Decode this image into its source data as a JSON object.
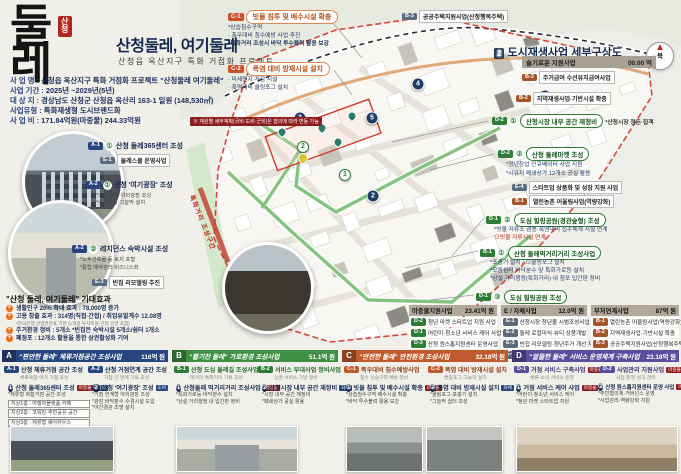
{
  "logo": {
    "main": "둘레",
    "seal": "산청"
  },
  "header": {
    "title": "산청둘레, 여기둘레",
    "subtitle": "산청읍 옥산지구 특화 거점화 프로젝트"
  },
  "info": [
    {
      "label": "사 업 명 :",
      "value": "산청읍 옥산지구 특화 거점화 프로젝트 \"산청둘레 여기둘레\""
    },
    {
      "label": "사업 기간 :",
      "value": "2025년 ~2029년(5년)"
    },
    {
      "label": "대 상 지 :",
      "value": "경상남도 산청군 산청읍 옥산리 163-1 일원 (148,530㎡)"
    },
    {
      "label": "사업유형 :",
      "value": "특화재생형 도시브랜드화"
    },
    {
      "label": "사 업 비 :",
      "value": "171.84억원(마중물) 244.33억원"
    }
  ],
  "info_note": "※ 재원별 세부계획(국비·도비·군비)은 협의에 따라 변동 가능",
  "map": {
    "title_num": "2",
    "title": "도시재생사업 세부구상도",
    "compass": "북",
    "top_tag": "B-3",
    "top_label": "공공주택지원사업(산청행복주택)",
    "road_label": "특화거리 조성구간",
    "markers": [
      {
        "type": "navy",
        "n": "1",
        "x": 292,
        "y": 262
      },
      {
        "type": "navy",
        "n": "2",
        "x": 373,
        "y": 196
      },
      {
        "type": "navy",
        "n": "3",
        "x": 300,
        "y": 118
      },
      {
        "type": "navy",
        "n": "4",
        "x": 418,
        "y": 84
      },
      {
        "type": "navy",
        "n": "5",
        "x": 372,
        "y": 118
      },
      {
        "type": "navy",
        "n": "6",
        "x": 545,
        "y": 96
      },
      {
        "type": "green",
        "n": "2",
        "x": 303,
        "y": 147
      },
      {
        "type": "green",
        "n": "1",
        "x": 345,
        "y": 175
      },
      {
        "type": "pin",
        "n": "",
        "x": 322,
        "y": 128
      },
      {
        "type": "pin",
        "n": "",
        "x": 352,
        "y": 116
      },
      {
        "type": "pin",
        "n": "",
        "x": 338,
        "y": 142
      },
      {
        "type": "pin",
        "n": "",
        "x": 282,
        "y": 132
      },
      {
        "type": "piny",
        "n": "",
        "x": 303,
        "y": 158
      }
    ]
  },
  "callouts": {
    "c1": {
      "id": "C-1",
      "title": "빗물 침투 및 배수시설 확충",
      "bullets": [
        "*상습침수구역",
        "· 폭우대비 침수예방 사업 추진",
        "*특화거리 조성시 바닥 투수블럭 활용 보강"
      ]
    },
    "c2": {
      "id": "C-2",
      "title": "폭염 대비 방재시설 설치",
      "bullets": [
        "· 미세먼지 저감 시설",
        "· 폭염대비 쿨링포그 설치"
      ]
    }
  },
  "left_features": {
    "f1": {
      "tag": "A-1",
      "num": "①",
      "title": "산청 둘레365센터 조성",
      "sub_tag": "E-1",
      "sub_text": "둘레스쿨 운영사업"
    },
    "f2": {
      "tag": "A-2",
      "num": "①",
      "title": "산청 '여기광장' 조성",
      "notes": [
        "*거점 연계 야외광장 조성",
        "*수경시설·그늘막 설치"
      ]
    },
    "f3": {
      "tag": "A-2",
      "num": "②",
      "title": "레지던스 숙박시설 조성",
      "bullets": [
        "*노후건축물 등 토지 포함",
        "*통합 예약관리 비즈니스화"
      ],
      "sub_tag": "E-3",
      "sub_text": "빈집 리모델링 추진"
    }
  },
  "effects": {
    "title": "\"산청 둘레, 여기둘레\" 기대효과",
    "items": [
      {
        "text": "생활인구 20% 확대 효과 : 78,000명 증가"
      },
      {
        "text": "고용 창출 효과 : 314명(직접·간접) / 취업유발계수 12.08명",
        "note": "*한국은행 산업연관표 기반 (1개점 투자지원·간접 유발 포함)"
      },
      {
        "text": "주거환경 정비 : 5개소  *빈집은 숙박시설 5개소/쉼터 1개소"
      },
      {
        "text": "폐점포 : 12개소 활용을 통한 상권활성화 기여"
      }
    ]
  },
  "right": {
    "bar_title": "슬기로운 지원사업",
    "bar_value": "00.00 억",
    "row1_tag": "B-3",
    "row1_text": "주거급여 수선유지급여사업",
    "row2_tag": "B-2",
    "row2_text": "지역재생사업·기반시설 확충",
    "g1": {
      "tag": "D-2",
      "num": "①",
      "title": "산청시장 내부 공간 재정비",
      "side": "*산청시장 정돈·집객"
    },
    "g2": {
      "tag": "D-2",
      "num": "②",
      "title": "산청 둘레마켓 조성",
      "b1": "*청년창업 인큐베이터 사업 지원",
      "b2": "*시유지 폐쇄상가 12개소 공실 활용",
      "s1_tag": "E-4",
      "s1_text": "스타트업 상품화 및 성장 지원 사업",
      "s2_tag": "B-1",
      "s2_text": "열린농촌 어울림사업(역량강화)"
    },
    "g3": {
      "tag": "D-1",
      "num": "②",
      "title": "도심 힐링공원(경관숲형) 조성",
      "b1": "*빗물 저류조 겸용·폭염대비 집수체계 시설 연계",
      "b2": "⊙빗물 저류시설 연계"
    },
    "g4": {
      "tag": "B-1",
      "num": "①",
      "title": "산청 둘레먹거리거리 조성사업",
      "b1": "*포충기 설치 / ⊙쿨링포그 설치",
      "b2": "*모둠쉼터 바닥분수 앞 특화가로등 설치",
      "b3": "*상설 거리행정(특화거리) 내 점포 입간판 정비"
    },
    "g5": {
      "tag": "D-1",
      "num": "③",
      "title": "도심 힐링공원 조성"
    }
  },
  "tables": [
    {
      "header": "마중물지원사업",
      "value": "23.41억 원",
      "rows": [
        {
          "tag": "D-2",
          "text": "청년 마켓 스타트업 지원 사업"
        },
        {
          "tag": "D-1",
          "text": "어린이·청소년 서비스 케어 사업"
        },
        {
          "tag": "D-3",
          "text": "산청 원스톱지원센터 운영사업"
        }
      ]
    },
    {
      "header": "E / 자체사업",
      "value": "12.0억 원",
      "rows": [
        {
          "tag": "E-1",
          "text": "산청시장 청년몰 시범조성사업"
        },
        {
          "tag": "E-2",
          "text": "둘레 로컬미식·뷰티 상품개발"
        },
        {
          "tag": "E-3",
          "text": "빈집 리모델링·청년주거 개선 지원"
        },
        {
          "tag": "E-4",
          "text": "스타트업 창업 및 성장 지원 사업"
        }
      ]
    },
    {
      "header": "부처연계사업",
      "value": "87억 원",
      "rows": [
        {
          "tag": "B-1",
          "text": "열린농촌 어울림사업(역량강화)"
        },
        {
          "tag": "B-2",
          "text": "지역재생사업·기반시설 확충"
        },
        {
          "tag": "B-3",
          "text": "공공주택지원사업(산청행복주택)"
        }
      ]
    }
  ],
  "cards": [
    {
      "letter": "A",
      "color": "#27457e",
      "title": "\"편안한 둘레\" 체류거점공간 조성사업",
      "amount": "116억 원",
      "sub1_tag": "A-1",
      "sub1_text": "산청 체류거점 공간 조성",
      "sub1_note": "체류복합·여가 거점 조성",
      "sub2_tag": "A-2",
      "sub2_text": "산청 거점연계 공간 조성",
      "sub2_note": "거점 간 연계 가로 조성",
      "i1": {
        "num": "①",
        "title": "산청 둘레365센터 조성",
        "tag1": "마중물",
        "tag2": "국비",
        "lines": [
          "*체류형 복합거점 공간 조성",
          "지상1층 : 여행자플랫폼·카페",
          "지상2층 : 코워킹·주민공유 공간",
          "지상3층 : 체류형 셰어하우스"
        ]
      },
      "i2": {
        "num": "②",
        "title": "산청 '여기광장' 조성",
        "tag1": "도비",
        "lines": [
          "*거점 연계형 야외광장 조성",
          "*광장 바닥분수·수경시설 도입",
          "*야간경관 조명 설치"
        ]
      }
    },
    {
      "letter": "B",
      "color": "#3e8f43",
      "title": "\"활기찬 둘레\" 가로환경 조성사업",
      "amount": "51.1억 원",
      "sub1_tag": "B-1",
      "sub1_text": "산청 도심 둘레길 조성사업",
      "sub1_note": "먹거리·특화거리 가로 조성",
      "sub2_tag": "B-2",
      "sub2_text": "서비스 부대사업 정비사업",
      "sub2_note": "상권 서비스 기반 정비",
      "i1": {
        "num": "①",
        "title": "산청둘레 먹거리거리 조성사업",
        "tag1": "마중물",
        "tag2": "도비",
        "lines": [
          "*특화가로등·바닥분수 설치",
          "*상설 거리행정 내 입간판 정비"
        ]
      },
      "i2": {
        "num": "②",
        "title": "산청시장 내부 공간 재정비",
        "tag1": "자체",
        "lines": [
          "*시장 내부 공간 재정비",
          "*폐쇄상가 공실 활용"
        ]
      }
    },
    {
      "letter": "C",
      "color": "#c05a2c",
      "title": "\"안전한 둘레\" 안전환경 조성사업",
      "amount": "32.18억 원",
      "sub1_tag": "C-1",
      "sub1_text": "폭우대비 침수예방사업",
      "sub1_note": "침수 상습구역 예방 정비",
      "sub2_tag": "C-2",
      "sub2_text": "폭염 대비 방재시설 설치",
      "sub2_note": "쿨링포그·그늘막 설치",
      "i1": {
        "num": "①",
        "title": "빗물 침투 및 배수시설 확충",
        "tag1": "마중물",
        "lines": [
          "*상습침수구역 배수시설 확충",
          "*바닥 투수블럭 활용 보강"
        ]
      },
      "i2": {
        "num": "②",
        "title": "폭염 대비 방재시설 설치",
        "tag1": "자체",
        "lines": [
          "*쿨링포그·포충기 설치",
          "*그늘막 쉼터 조성"
        ]
      }
    },
    {
      "letter": "D",
      "color": "#5b4e9e",
      "title": "\"알뜰한 둘레\" 서비스 운영체계 구축사업",
      "amount": "23.18억 원",
      "sub1_tag": "D-1",
      "sub1_text": "거점 서비스 구축사업",
      "sub1_note": "체류·소비 서비스 운영",
      "sub1_badge": "마중물",
      "sub2_tag": "D-2",
      "sub2_text": "사업관리 지원사업",
      "sub2_note": "사업 운영·성과 관리",
      "sub2_badge": "마중물",
      "i1": {
        "num": "①",
        "title": "거점 서비스 케어 사업",
        "tag1": "마중물",
        "lines": [
          "*어린이·청소년 서비스 케어",
          "*청년 마켓 스타트업 지원"
        ]
      },
      "i2": {
        "num": "②",
        "title": "산청 원스톱지원센터 운영 사업",
        "tag1": "마중물",
        "lines": [
          "*주민협의체·거버넌스 운영",
          "*사업관리·역량강화 지원"
        ]
      }
    }
  ]
}
